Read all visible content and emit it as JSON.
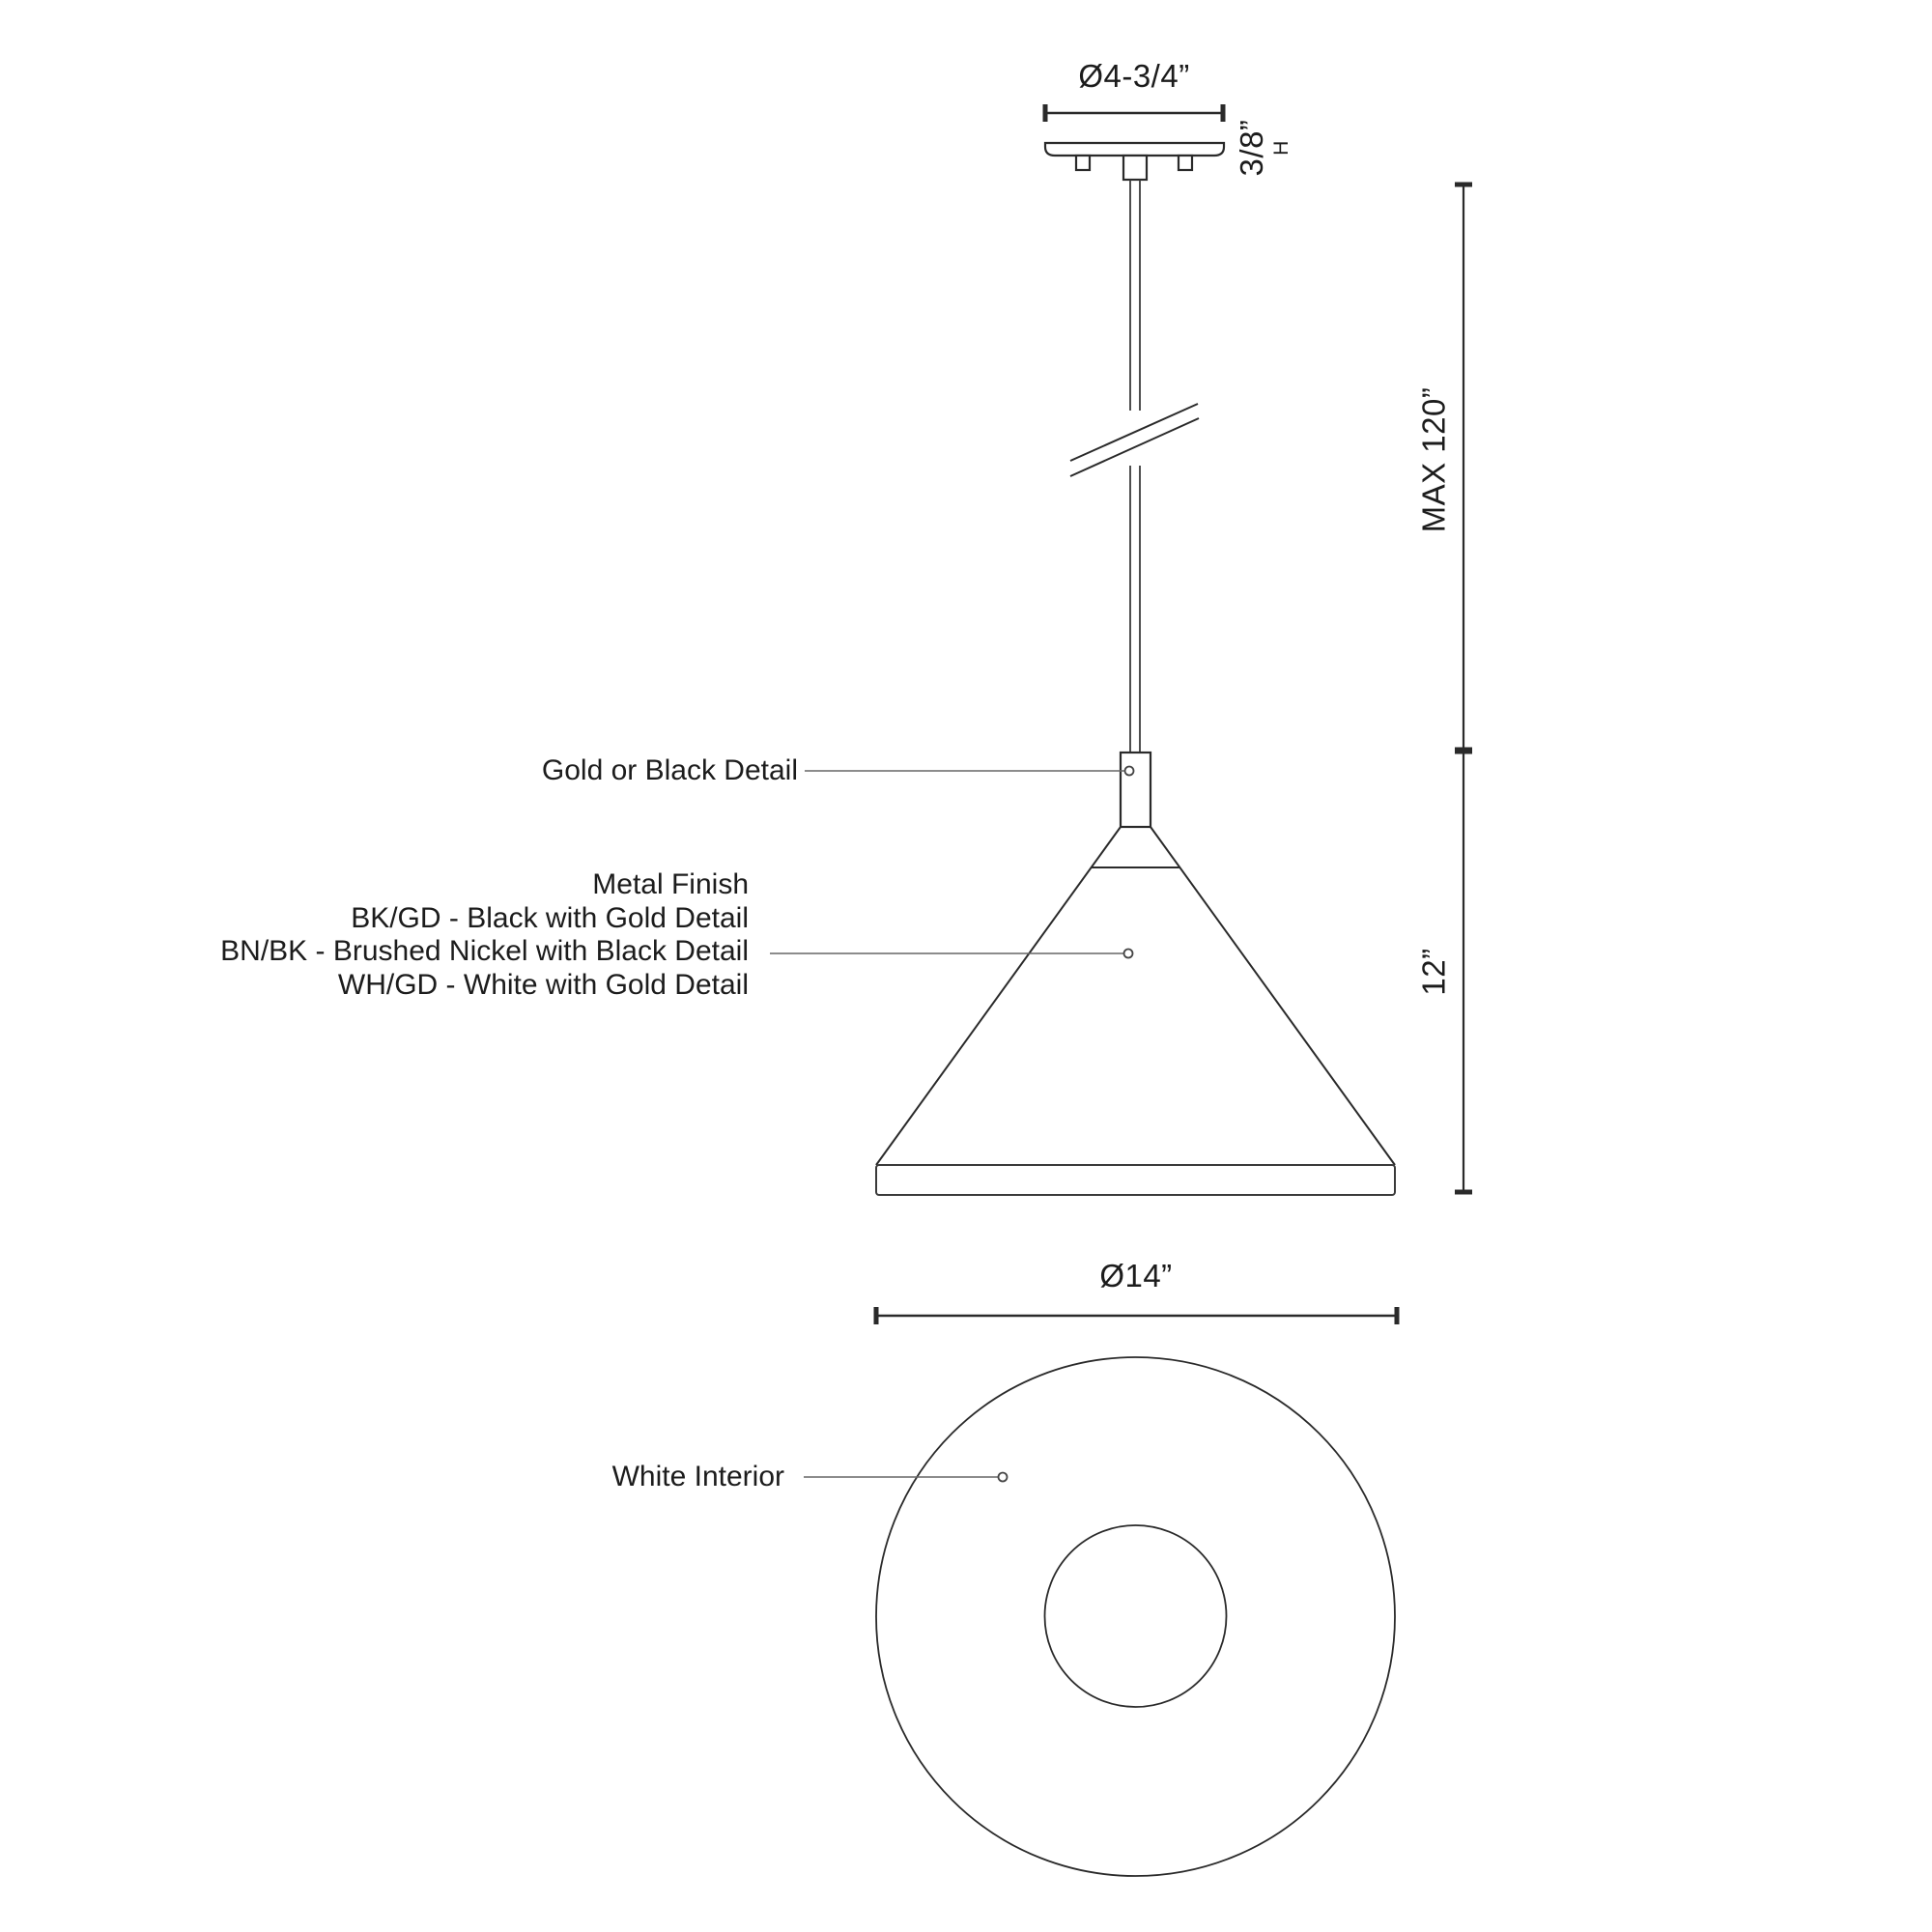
{
  "drawing": {
    "type": "pendant-light-dimension-diagram",
    "labels": {
      "gold_or_black_detail": "Gold or Black Detail",
      "white_interior": "White Interior"
    },
    "finish_note": {
      "line1": "Metal Finish",
      "line2": "BK/GD - Black with Gold Detail",
      "line3": "BN/BK - Brushed Nickel with Black Detail",
      "line4": "WH/GD - White with Gold Detail"
    },
    "dimensions": {
      "canopy_diameter": "Ø4-3/4”",
      "canopy_height": "3/8”",
      "canopy_height_suffix": "H",
      "max_drop": "MAX 120”",
      "shade_height": "12”",
      "shade_diameter": "Ø14”"
    },
    "colors": {
      "line": "#2a2a2a",
      "leader": "#666666",
      "background": "#ffffff"
    }
  }
}
